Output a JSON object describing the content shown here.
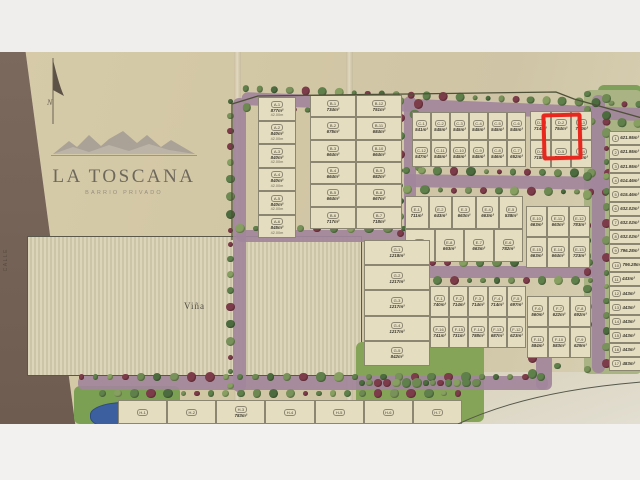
{
  "branding": {
    "name": "LA TOSCANA",
    "subtitle": "BARRIO PRIVADO",
    "north": "N"
  },
  "labels": {
    "vineyard": "Viña",
    "left_street": "CALLE"
  },
  "highlight": {
    "lot": "D-2",
    "area": "754m²",
    "color": "#e8281e"
  },
  "colors": {
    "paper": "#d4c9a7",
    "road": "#a2859b",
    "tree_green": "#5f7f4b",
    "tree_maroon": "#7d3c49",
    "pond": "#3c5f9f",
    "highlight": "#e8281e"
  },
  "blocks": {
    "A": [
      {
        "label": "A-1",
        "area": "877m²",
        "dim": "42.00m"
      },
      {
        "label": "A-2",
        "area": "840m²",
        "dim": "42.00m"
      },
      {
        "label": "A-3",
        "area": "840m²",
        "dim": "42.00m"
      },
      {
        "label": "A-4",
        "area": "840m²",
        "dim": "42.00m"
      },
      {
        "label": "A-5",
        "area": "840m²",
        "dim": "42.00m"
      },
      {
        "label": "A-6",
        "area": "845m²",
        "dim": "42.00m"
      }
    ],
    "B": {
      "left": [
        {
          "label": "B-1",
          "area": "734m²"
        },
        {
          "label": "B-2",
          "area": "675m²"
        },
        {
          "label": "B-3",
          "area": "664m²"
        },
        {
          "label": "B-4",
          "area": "664m²"
        },
        {
          "label": "B-5",
          "area": "664m²"
        },
        {
          "label": "B-6",
          "area": "717m²"
        }
      ],
      "right": [
        {
          "label": "B-12",
          "area": "751m²"
        },
        {
          "label": "B-11",
          "area": "684m²"
        },
        {
          "label": "B-10",
          "area": "664m²"
        },
        {
          "label": "B-9",
          "area": "682m²"
        },
        {
          "label": "B-8",
          "area": "667m²"
        },
        {
          "label": "B-7",
          "area": "718m²"
        }
      ]
    },
    "C": {
      "rows": [
        [
          {
            "label": "C-1",
            "area": "541m²"
          },
          {
            "label": "C-2",
            "area": "545m²"
          },
          {
            "label": "C-3",
            "area": "545m²"
          },
          {
            "label": "C-4",
            "area": "545m²"
          },
          {
            "label": "C-5",
            "area": "545m²"
          },
          {
            "label": "C-6",
            "area": "545m²"
          }
        ],
        [
          {
            "label": "C-12",
            "area": "547m²"
          },
          {
            "label": "C-11",
            "area": "545m²"
          },
          {
            "label": "C-10",
            "area": "545m²"
          },
          {
            "label": "C-9",
            "area": "545m²"
          },
          {
            "label": "C-8",
            "area": "546m²"
          },
          {
            "label": "C-7",
            "area": "652m²"
          }
        ]
      ]
    },
    "D": {
      "rows": [
        [
          {
            "label": "D-1",
            "area": "714m²"
          },
          {
            "label": "D-2",
            "area": "754m²",
            "highlight": true
          },
          {
            "label": "D-3",
            "area": "754m²"
          }
        ],
        [
          {
            "label": "D-6",
            "area": "718m²"
          },
          {
            "label": "D-5",
            "area": "754m²"
          },
          {
            "label": "D-4",
            "area": "711m²"
          }
        ]
      ]
    },
    "E": {
      "rows": [
        [
          {
            "label": "E-1",
            "area": "711m²"
          },
          {
            "label": "E-2",
            "area": "643m²"
          },
          {
            "label": "E-3",
            "area": "663m²"
          },
          {
            "label": "E-4",
            "area": "663m²"
          },
          {
            "label": "E-5",
            "area": "538m²"
          }
        ],
        [
          {
            "label": "E-9",
            "area": "658m²"
          },
          {
            "label": "E-8",
            "area": "663m²"
          },
          {
            "label": "E-7",
            "area": "663m²"
          },
          {
            "label": "E-6",
            "area": "782m²"
          }
        ]
      ]
    },
    "E2": {
      "rows": [
        [
          {
            "label": "E-10",
            "area": "663m²"
          },
          {
            "label": "E-11",
            "area": "663m²"
          },
          {
            "label": "E-12",
            "area": "783m²"
          }
        ],
        [
          {
            "label": "E-15",
            "area": "663m²"
          },
          {
            "label": "E-14",
            "area": "664m²"
          },
          {
            "label": "E-13",
            "area": "723m²"
          }
        ]
      ]
    },
    "F": {
      "rows": [
        [
          {
            "label": "F-1",
            "area": "740m²"
          },
          {
            "label": "F-2",
            "area": "714m²"
          },
          {
            "label": "F-3",
            "area": "714m²"
          },
          {
            "label": "F-4",
            "area": "714m²"
          },
          {
            "label": "F-5",
            "area": "697m²"
          }
        ],
        [
          {
            "label": "F-16",
            "area": "741m²"
          },
          {
            "label": "F-15",
            "area": "731m²"
          },
          {
            "label": "F-14",
            "area": "788m²"
          },
          {
            "label": "F-13",
            "area": "687m²"
          },
          {
            "label": "F-12",
            "area": "623m²"
          }
        ]
      ]
    },
    "F2": {
      "rows": [
        [
          {
            "label": "F-6",
            "area": "560m²"
          },
          {
            "label": "F-7",
            "area": "622m²"
          },
          {
            "label": "F-8",
            "area": "692m²"
          }
        ],
        [
          {
            "label": "F-11",
            "area": "584m²"
          },
          {
            "label": "F-10",
            "area": "583m²"
          },
          {
            "label": "F-9",
            "area": "629m²"
          }
        ]
      ]
    },
    "G": [
      {
        "label": "G-1",
        "area": "1218m²"
      },
      {
        "label": "G-2",
        "area": "1217m²"
      },
      {
        "label": "G-3",
        "area": "1217m²"
      },
      {
        "label": "G-4",
        "area": "1217m²"
      },
      {
        "label": "G-5",
        "area": "842m²"
      }
    ],
    "R": [
      {
        "label": "1",
        "area": "621.95m²"
      },
      {
        "label": "2",
        "area": "621.95m²"
      },
      {
        "label": "3",
        "area": "621.95m²"
      },
      {
        "label": "4",
        "area": "614.46m²"
      },
      {
        "label": "5",
        "area": "615.46m²"
      },
      {
        "label": "6",
        "area": "632.02m²"
      },
      {
        "label": "7",
        "area": "632.02m²"
      },
      {
        "label": "8",
        "area": "632.02m²"
      },
      {
        "label": "9",
        "area": "796.28m²"
      },
      {
        "label": "10",
        "area": "796.28m²"
      },
      {
        "label": "11",
        "area": "443m²"
      },
      {
        "label": "12",
        "area": "443m²"
      },
      {
        "label": "13",
        "area": "443m²"
      },
      {
        "label": "14",
        "area": "443m²"
      },
      {
        "label": "15",
        "area": "443m²"
      },
      {
        "label": "16",
        "area": "443m²"
      },
      {
        "label": "17",
        "area": "483m²"
      }
    ],
    "H": {
      "rows": [
        [
          {
            "label": "H-1",
            "area": ""
          },
          {
            "label": "H-2",
            "area": ""
          },
          {
            "label": "H-3",
            "area": "783m²"
          },
          {
            "label": "H-4",
            "area": ""
          },
          {
            "label": "H-5",
            "area": ""
          },
          {
            "label": "H-6",
            "area": ""
          },
          {
            "label": "H-7",
            "area": ""
          }
        ]
      ]
    }
  }
}
